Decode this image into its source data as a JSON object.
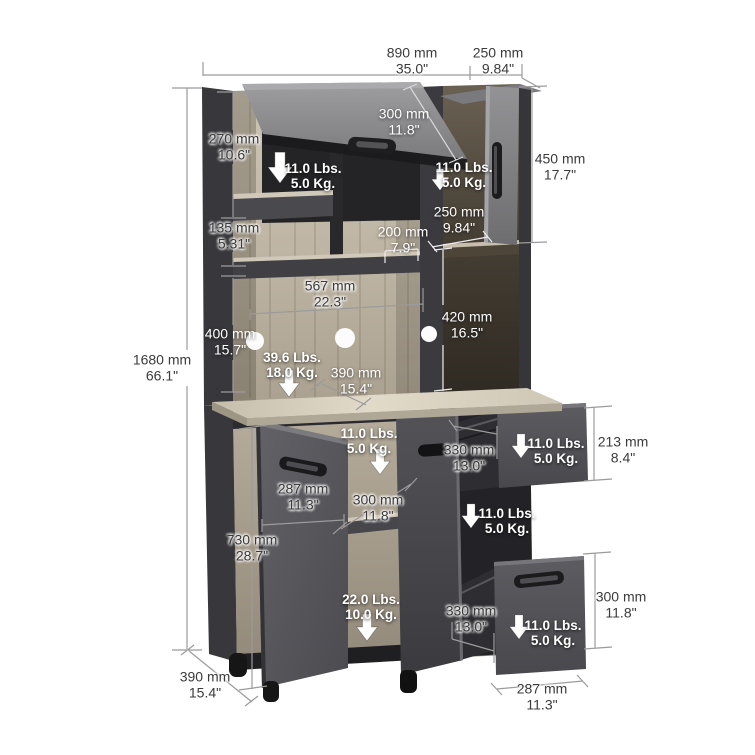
{
  "diagram": {
    "background": "#ffffff",
    "capacity_arrow_icon": "down-arrow",
    "colors": {
      "cabinet_dark_panel": "#3a3a3e",
      "cabinet_door_gray": "#8f8f92",
      "wood_light": "#c6bdae",
      "wood_dark": "#4a4136",
      "countertop": "#d7cfbe",
      "dimension_line": "#9b9b9b",
      "text_dark": "#3b3b3b",
      "text_light": "#ffffff"
    }
  },
  "dimensions": {
    "overall_width": {
      "mm": "890 mm",
      "inches": "35.0\""
    },
    "top_depth": {
      "mm": "250 mm",
      "inches": "9.84\""
    },
    "flip_door_height": {
      "mm": "300 mm",
      "inches": "11.8\""
    },
    "upper_left_opening_height": {
      "mm": "270 mm",
      "inches": "10.6\""
    },
    "upper_right_door_height": {
      "mm": "450 mm",
      "inches": "17.7\""
    },
    "upper_right_shelf_depth": {
      "mm": "250 mm",
      "inches": "9.84\""
    },
    "shelf_spacing": {
      "mm": "135 mm",
      "inches": "5.31\""
    },
    "small_shelf_depth": {
      "mm": "200 mm",
      "inches": "7.9\""
    },
    "center_opening_width": {
      "mm": "567 mm",
      "inches": "22.3\""
    },
    "upper_right_opening_height": {
      "mm": "420 mm",
      "inches": "16.5\""
    },
    "center_opening_height": {
      "mm": "400 mm",
      "inches": "15.7\""
    },
    "overall_height": {
      "mm": "1680 mm",
      "inches": "66.1\""
    },
    "counter_depth": {
      "mm": "390 mm",
      "inches": "15.4\""
    },
    "base_door_width": {
      "mm": "287 mm",
      "inches": "11.3\""
    },
    "base_shelf_depth": {
      "mm": "300 mm",
      "inches": "11.8\""
    },
    "base_height": {
      "mm": "730 mm",
      "inches": "28.7\""
    },
    "top_drawer_depth": {
      "mm": "330 mm",
      "inches": "13.0\""
    },
    "top_drawer_height": {
      "mm": "213 mm",
      "inches": "8.4\""
    },
    "bottom_drawer_depth": {
      "mm": "330 mm",
      "inches": "13.0\""
    },
    "bottom_drawer_height": {
      "mm": "300 mm",
      "inches": "11.8\""
    },
    "base_depth": {
      "mm": "390 mm",
      "inches": "15.4\""
    },
    "bottom_drawer_width": {
      "mm": "287 mm",
      "inches": "11.3\""
    }
  },
  "weight_capacities": {
    "upper_left_shelf": {
      "lbs": "11.0 Lbs.",
      "kg": "5.0 Kg."
    },
    "upper_right_shelf": {
      "lbs": "11.0 Lbs.",
      "kg": "5.0 Kg."
    },
    "countertop": {
      "lbs": "39.6 Lbs.",
      "kg": "18.0 Kg."
    },
    "base_upper_shelf": {
      "lbs": "11.0 Lbs.",
      "kg": "5.0 Kg."
    },
    "top_drawer": {
      "lbs": "11.0 Lbs.",
      "kg": "5.0 Kg."
    },
    "base_middle_shelf": {
      "lbs": "11.0 Lbs.",
      "kg": "5.0 Kg."
    },
    "base_lower_shelf": {
      "lbs": "22.0 Lbs.",
      "kg": "10.0 Kg."
    },
    "bottom_drawer": {
      "lbs": "11.0 Lbs.",
      "kg": "5.0 Kg."
    }
  }
}
